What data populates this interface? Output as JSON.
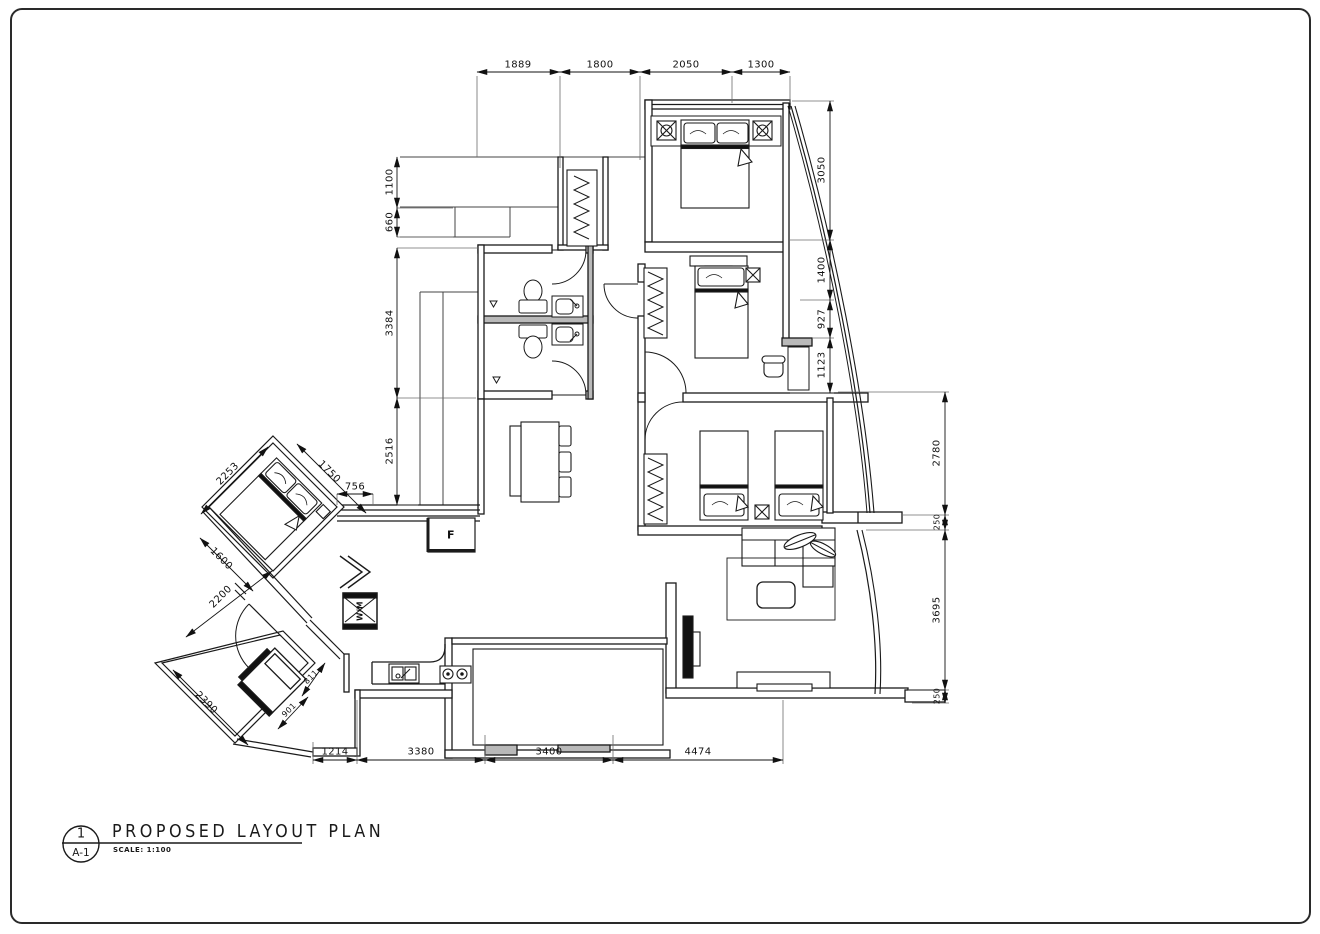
{
  "plan": {
    "title_block": {
      "detail_number": "1",
      "sheet_number": "A-1",
      "title": "PROPOSED LAYOUT PLAN",
      "scale_label": "SCALE: 1:100"
    },
    "room_labels": {
      "fridge": "F",
      "washing_machine": "W/M"
    },
    "dimensions": {
      "top": [
        "1889",
        "1800",
        "2050",
        "1300"
      ],
      "left": [
        "1100",
        "660",
        "3384",
        "2516"
      ],
      "right_inner": [
        "3050",
        "1400",
        "927",
        "1123"
      ],
      "right_outer": [
        "2780",
        "250",
        "3695",
        "250"
      ],
      "bottom": [
        "1214",
        "3380",
        "3400",
        "4474"
      ],
      "diagonal": [
        "2253",
        "1750",
        "756",
        "1600",
        "2200",
        "2390",
        "901",
        "811"
      ]
    },
    "colors": {
      "line": "#1a1a1a",
      "ext_line": "#6b6b6b",
      "wall_gray": "#b9b9b9",
      "bg": "#ffffff"
    }
  }
}
